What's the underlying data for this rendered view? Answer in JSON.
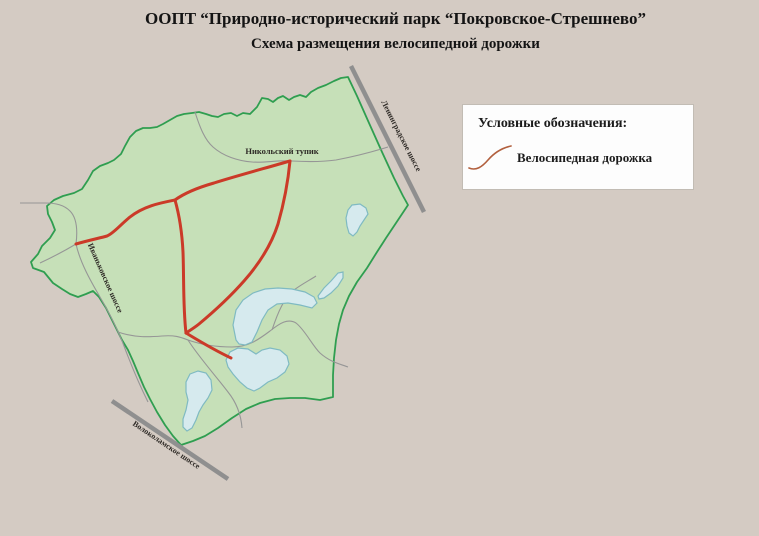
{
  "title": "ООПТ “Природно-исторический парк “Покровское-Стрешнево”",
  "subtitle": "Схема размещения велосипедной дорожки",
  "legend": {
    "heading": "Условные обозначения:",
    "items": [
      {
        "label": "Велосипедная дорожка",
        "icon": "bike-path-squiggle-icon"
      }
    ]
  },
  "map": {
    "labels": {
      "dead_end_road": "Никольский тупик",
      "highway_ne": "Ленинградское шоссе",
      "highway_west": "Иваньковское шоссе",
      "highway_south": "Волоколамское шоссе"
    },
    "colors": {
      "background": "#d4cbc3",
      "park_fill": "#c6e0b8",
      "park_border": "#2f9e50",
      "lake_fill": "#d6eaee",
      "lake_border": "#7fbac2",
      "bike_path": "#cb3a28",
      "road": "#8f8f8f",
      "trail": "#969696",
      "road_label": "#2e2a26",
      "legend_squiggle": "#b2603e"
    }
  }
}
